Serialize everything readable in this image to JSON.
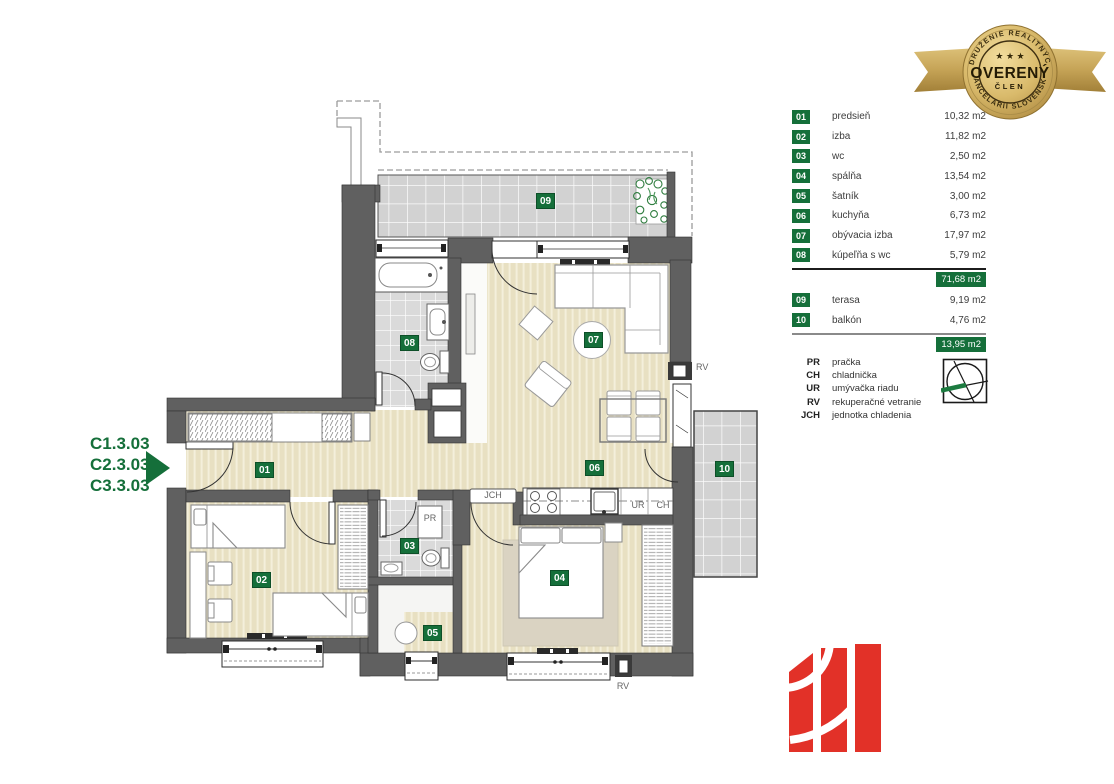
{
  "codes": {
    "lines": [
      "C1.3.03",
      "C2.3.03",
      "C3.3.03"
    ]
  },
  "badge": {
    "top_text": "ZDRUŽENIE REALITNÝCH",
    "bottom_text": "KANCELÁRIÍ SLOVENSKA",
    "stars": "★ ★ ★",
    "center": "OVERENÝ",
    "sub": "ČLEN"
  },
  "legend": {
    "rooms": [
      {
        "num": "01",
        "name": "predsieň",
        "area": "10,32 m2"
      },
      {
        "num": "02",
        "name": "izba",
        "area": "11,82 m2"
      },
      {
        "num": "03",
        "name": "wc",
        "area": "2,50 m2"
      },
      {
        "num": "04",
        "name": "spálňa",
        "area": "13,54 m2"
      },
      {
        "num": "05",
        "name": "šatník",
        "area": "3,00 m2"
      },
      {
        "num": "06",
        "name": "kuchyňa",
        "area": "6,73 m2"
      },
      {
        "num": "07",
        "name": "obývacia izba",
        "area": "17,97 m2"
      },
      {
        "num": "08",
        "name": "kúpeľňa s wc",
        "area": "5,79 m2"
      }
    ],
    "total_main": "71,68 m2",
    "outdoor": [
      {
        "num": "09",
        "name": "terasa",
        "area": "9,19 m2"
      },
      {
        "num": "10",
        "name": "balkón",
        "area": "4,76 m2"
      }
    ],
    "total_outdoor": "13,95 m2"
  },
  "abbreviations": [
    {
      "abbr": "PR",
      "name": "pračka"
    },
    {
      "abbr": "CH",
      "name": "chladnička"
    },
    {
      "abbr": "UR",
      "name": "umývačka riadu"
    },
    {
      "abbr": "RV",
      "name": "rekuperačné vetranie"
    },
    {
      "abbr": "JCH",
      "name": "jednotka chladenia"
    }
  ],
  "plan_labels": {
    "r01": "01",
    "r02": "02",
    "r03": "03",
    "r04": "04",
    "r05": "05",
    "r06": "06",
    "r07": "07",
    "r08": "08",
    "r09": "09",
    "r10": "10",
    "pr": "PR",
    "ur": "UR",
    "ch": "CH",
    "jch": "JCH",
    "rv_right": "RV",
    "rv_bottom": "RV"
  },
  "colors": {
    "accent_green": "#156f3a",
    "wall_gray": "#606060",
    "floor_beige": "#e8e0c2",
    "tile_gray": "#dadada",
    "logo_red": "#e23128",
    "badge_gold": "#c9a64f"
  }
}
